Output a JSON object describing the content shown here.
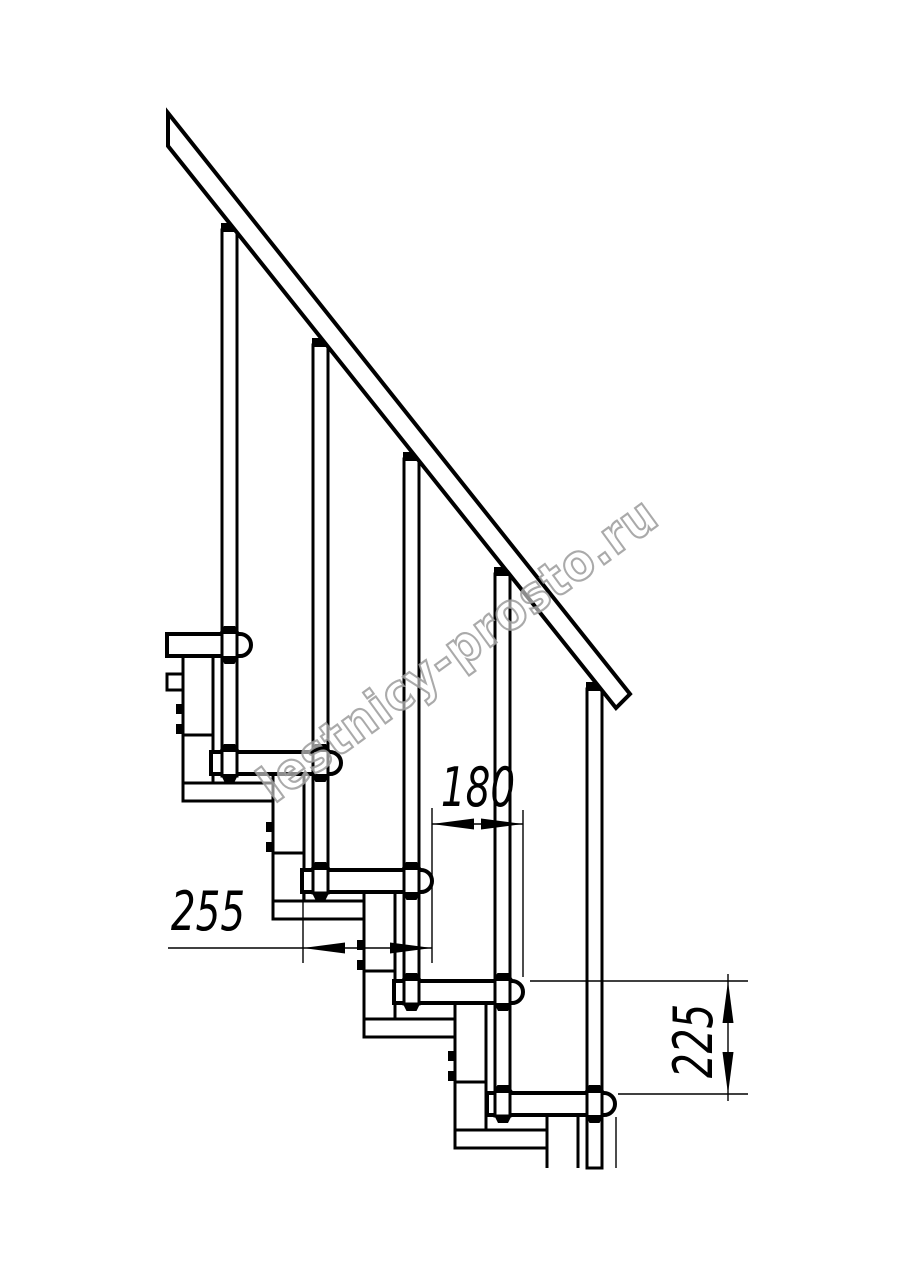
{
  "drawing": {
    "type": "modular-staircase-side-view",
    "dimensions": {
      "step_offset_label": "180",
      "tread_depth_label": "255",
      "riser_height_label": "225"
    },
    "watermark_text": "lestnicy-prosto.ru",
    "colors": {
      "line": "#000000",
      "watermark_stroke": "#9b9b9b",
      "background": "#ffffff"
    }
  }
}
